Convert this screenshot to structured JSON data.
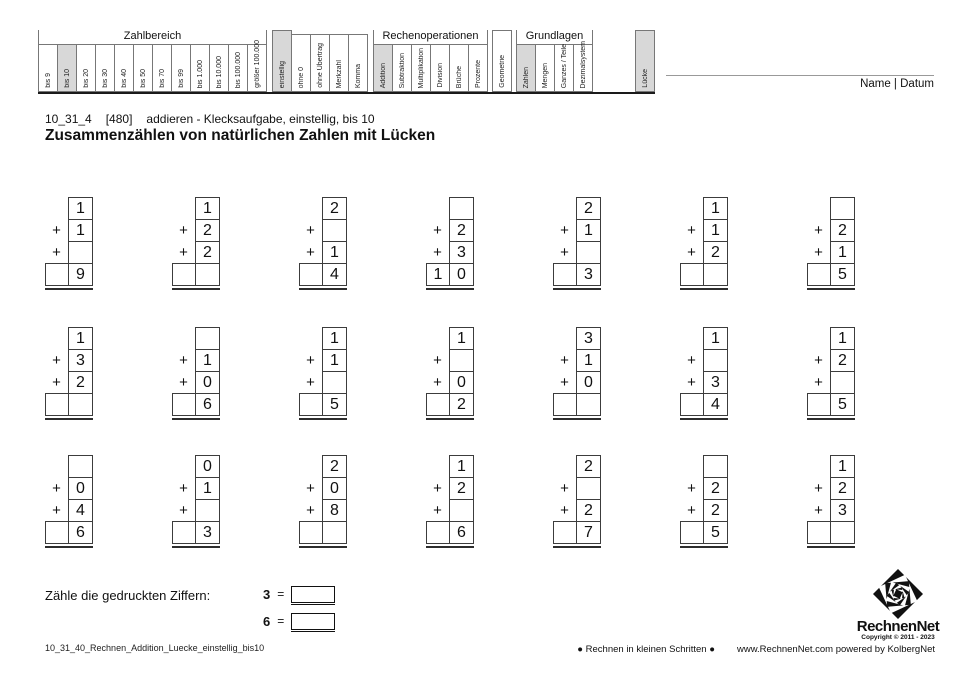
{
  "colors": {
    "highlight": "#d8d8d8",
    "page": "#ffffff"
  },
  "labels": {
    "plus": "+"
  },
  "name_date": "Name | Datum",
  "meta": {
    "code": "10_31_4",
    "ref": "[480]",
    "desc": "addieren - Klecksaufgabe, einstellig, bis 10"
  },
  "title": "Zusammenzählen von natürlichen Zahlen mit Lücken",
  "filters": {
    "zahlbereich": {
      "label": "Zahlbereich",
      "cols": [
        "bis 9",
        "bis 10",
        "bis 20",
        "bis 30",
        "bis 40",
        "bis 50",
        "bis 70",
        "bis 99",
        "bis 1.000",
        "bis 10.000",
        "bis 100.000",
        "größer 100.000"
      ],
      "highlighted": [
        "bis 10"
      ]
    },
    "modifiers": [
      "einstellig",
      "ohne 0",
      "ohne Übertrag",
      "Merkzahl",
      "Komma"
    ],
    "modifiers_highlighted": [
      "einstellig"
    ],
    "rechenoperationen": {
      "label": "Rechenoperationen",
      "cols": [
        "Addition",
        "Subtraktion",
        "Multiplikation",
        "Division",
        "Brüche",
        "Prozente"
      ],
      "highlighted": [
        "Addition"
      ]
    },
    "geometrie": "Geometrie",
    "grundlagen": {
      "label": "Grundlagen",
      "cols": [
        "Zahlen",
        "Mengen",
        "Ganzes / Teile",
        "Dezimalsystem"
      ],
      "highlighted": [
        "Zahlen"
      ]
    },
    "luecke": "Lücke"
  },
  "problems": [
    {
      "addends": [
        "1",
        "1",
        ""
      ],
      "result_tens": "",
      "result_ones": "9"
    },
    {
      "addends": [
        "1",
        "2",
        "2"
      ],
      "result_tens": "",
      "result_ones": ""
    },
    {
      "addends": [
        "2",
        "",
        "1"
      ],
      "result_tens": "",
      "result_ones": "4"
    },
    {
      "addends": [
        "",
        "2",
        "3"
      ],
      "result_tens": "1",
      "result_ones": "0"
    },
    {
      "addends": [
        "2",
        "1",
        ""
      ],
      "result_tens": "",
      "result_ones": "3"
    },
    {
      "addends": [
        "1",
        "1",
        "2"
      ],
      "result_tens": "",
      "result_ones": ""
    },
    {
      "addends": [
        "",
        "2",
        "1"
      ],
      "result_tens": "",
      "result_ones": "5"
    },
    {
      "addends": [
        "1",
        "3",
        "2"
      ],
      "result_tens": "",
      "result_ones": ""
    },
    {
      "addends": [
        "",
        "1",
        "0"
      ],
      "result_tens": "",
      "result_ones": "6"
    },
    {
      "addends": [
        "1",
        "1",
        ""
      ],
      "result_tens": "",
      "result_ones": "5"
    },
    {
      "addends": [
        "1",
        "",
        "0"
      ],
      "result_tens": "",
      "result_ones": "2"
    },
    {
      "addends": [
        "3",
        "1",
        "0"
      ],
      "result_tens": "",
      "result_ones": ""
    },
    {
      "addends": [
        "1",
        "",
        "3"
      ],
      "result_tens": "",
      "result_ones": "4"
    },
    {
      "addends": [
        "1",
        "2",
        ""
      ],
      "result_tens": "",
      "result_ones": "5"
    },
    {
      "addends": [
        "",
        "0",
        "4"
      ],
      "result_tens": "",
      "result_ones": "6"
    },
    {
      "addends": [
        "0",
        "1",
        ""
      ],
      "result_tens": "",
      "result_ones": "3"
    },
    {
      "addends": [
        "2",
        "0",
        "8"
      ],
      "result_tens": "",
      "result_ones": ""
    },
    {
      "addends": [
        "1",
        "2",
        ""
      ],
      "result_tens": "",
      "result_ones": "6"
    },
    {
      "addends": [
        "2",
        "",
        "2"
      ],
      "result_tens": "",
      "result_ones": "7"
    },
    {
      "addends": [
        "",
        "2",
        "2"
      ],
      "result_tens": "",
      "result_ones": "5"
    },
    {
      "addends": [
        "1",
        "2",
        "3"
      ],
      "result_tens": "",
      "result_ones": ""
    }
  ],
  "count_task": {
    "label": "Zähle die gedruckten Ziffern:",
    "rows": [
      {
        "digit": "3",
        "eq": "=",
        "value": ""
      },
      {
        "digit": "6",
        "eq": "=",
        "value": ""
      }
    ]
  },
  "logo": {
    "name": "RechnenNet",
    "copyright": "Copyright © 2011 - 2023"
  },
  "footer": {
    "left": "10_31_40_Rechnen_Addition_Luecke_einstellig_bis10",
    "center": "● Rechnen in kleinen Schritten ●",
    "right": "www.RechnenNet.com powered by KolbergNet"
  }
}
